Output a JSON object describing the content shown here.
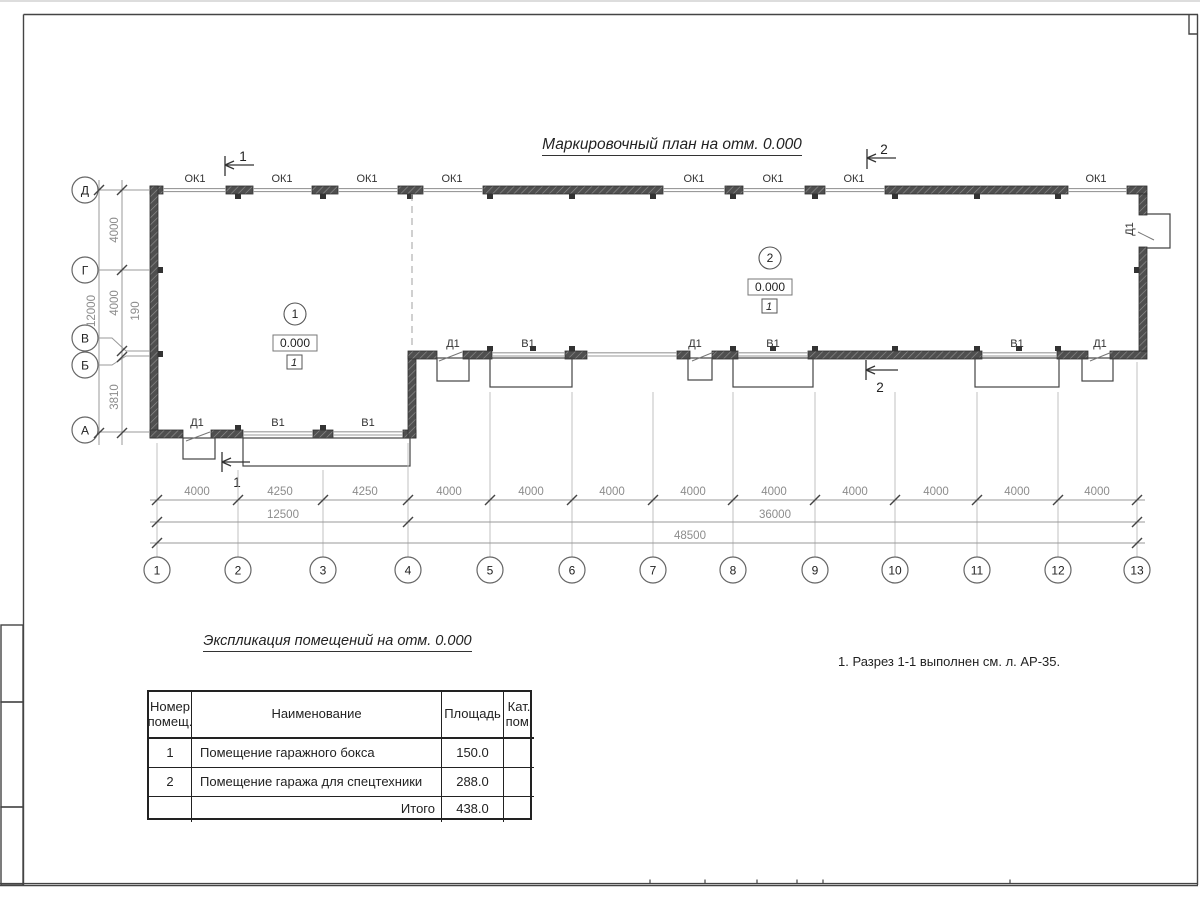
{
  "sheet": {
    "title": "Маркировочный план на отм. 0.000",
    "note": "1. Разрез 1-1 выполнен см. л. АР-35."
  },
  "plan": {
    "marks": {
      "window": "ОК1",
      "gate": "В1",
      "door": "Д1"
    },
    "sections": {
      "one": "1",
      "two": "2"
    },
    "rooms": [
      {
        "number": "1",
        "elevation": "0.000",
        "floor": "1"
      },
      {
        "number": "2",
        "elevation": "0.000",
        "floor": "1"
      }
    ],
    "axes_letters": [
      "Д",
      "Г",
      "В",
      "Б",
      "А"
    ],
    "axes_numbers": [
      "1",
      "2",
      "3",
      "4",
      "5",
      "6",
      "7",
      "8",
      "9",
      "10",
      "11",
      "12",
      "13"
    ],
    "dims_bottom": [
      "4000",
      "4250",
      "4250",
      "4000",
      "4000",
      "4000",
      "4000",
      "4000",
      "4000",
      "4000",
      "4000",
      "4000"
    ],
    "dims_totals": [
      "12500",
      "36000",
      "48500"
    ],
    "dims_left": [
      "4000",
      "4000",
      "190",
      "3810"
    ],
    "dims_left_total": "12000"
  },
  "table": {
    "title": "Экспликация помещений на отм. 0.000",
    "headers": [
      "Номер помещ.",
      "Наименование",
      "Площадь",
      "Кат. пом."
    ],
    "rows": [
      {
        "number": "1",
        "name": "Помещение гаражного бокса",
        "area": "150.0",
        "category": ""
      },
      {
        "number": "2",
        "name": "Помещение гаража для спецтехники",
        "area": "288.0",
        "category": ""
      }
    ],
    "total_label": "Итого",
    "total_area": "438.0"
  }
}
